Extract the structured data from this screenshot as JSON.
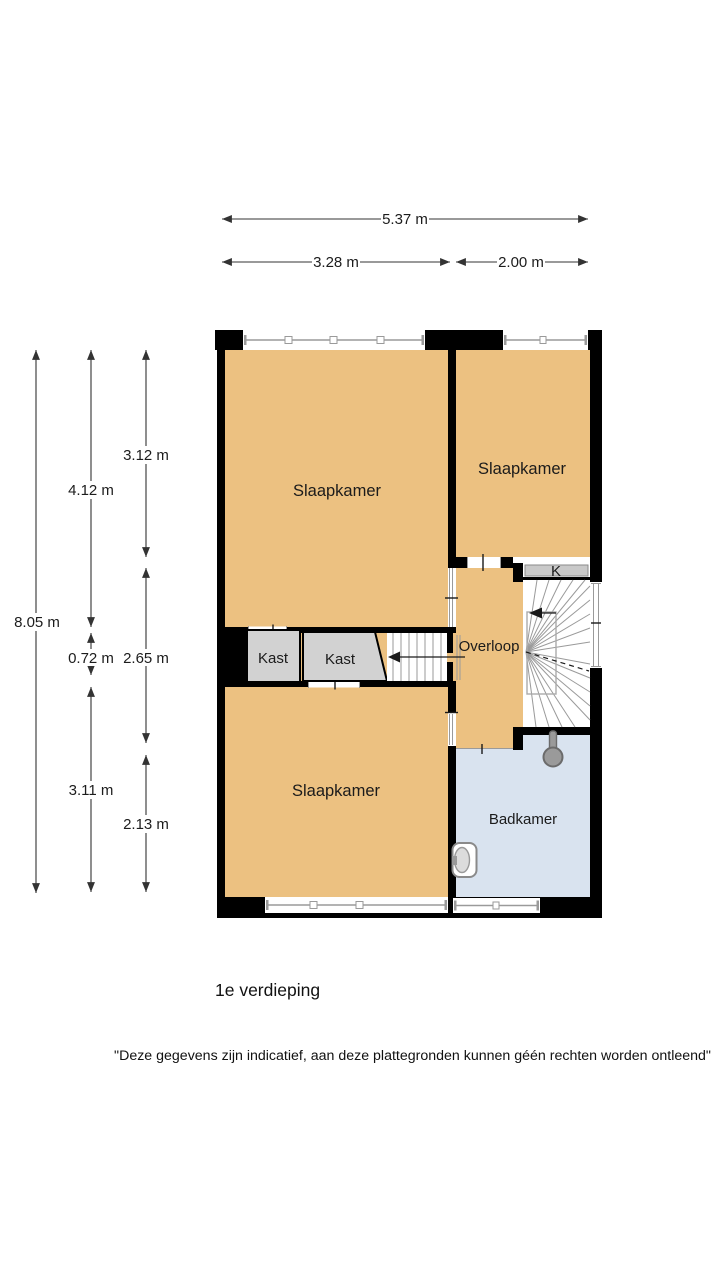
{
  "page": {
    "floor_title": "1e verdieping",
    "disclaimer": "\"Deze gegevens zijn indicatief, aan deze plattegronden kunnen géén rechten worden ontleend\""
  },
  "rooms": {
    "bedroom_top_left": {
      "label": "Slaapkamer"
    },
    "bedroom_top_right": {
      "label": "Slaapkamer"
    },
    "bedroom_bottom": {
      "label": "Slaapkamer"
    },
    "closet_left": {
      "label": "Kast"
    },
    "closet_right": {
      "label": "Kast"
    },
    "landing": {
      "label": "Overloop"
    },
    "bathroom": {
      "label": "Badkamer"
    },
    "small_closet": {
      "label": "K"
    }
  },
  "dimensions": {
    "top": {
      "total": "5.37 m",
      "left": "3.28 m",
      "right": "2.00 m"
    },
    "left": {
      "total": "8.05 m",
      "col2_top": "4.12 m",
      "col2_mid": "0.72 m",
      "col2_bottom": "3.11 m",
      "col3_top": "3.12 m",
      "col3_mid": "2.65 m",
      "col3_bottom": "2.13 m"
    }
  },
  "colors": {
    "room_fill": "#ecc181",
    "bathroom_fill": "#d9e3ef",
    "closet_fill": "#d2d2d2",
    "small_closet_fill": "#c9c9c9",
    "wall": "#000000",
    "stair_line": "#999999",
    "dimension_line": "#333333"
  }
}
